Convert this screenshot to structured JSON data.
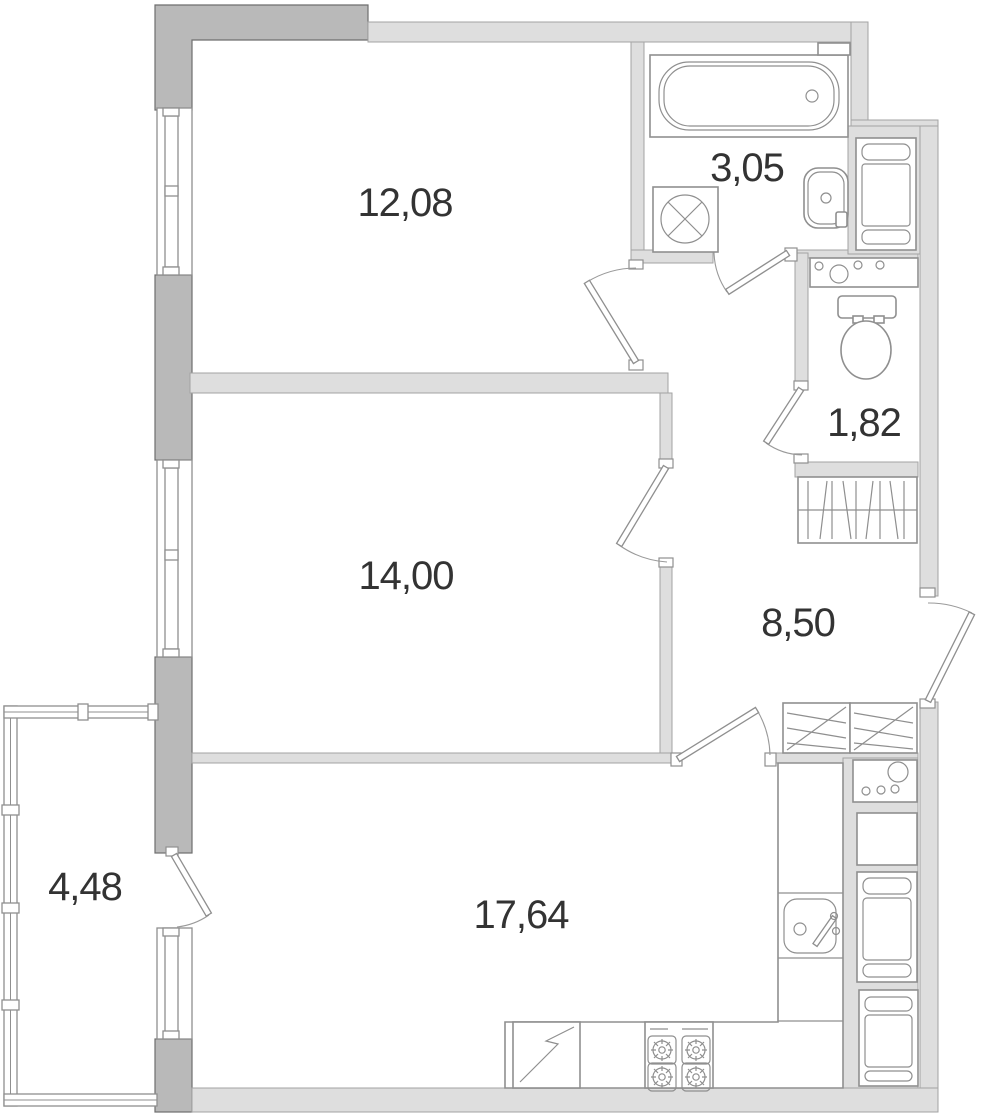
{
  "title": "apartment-floor-plan",
  "colors": {
    "background": "#ffffff",
    "wall_light": "#dedede",
    "wall_light_stroke": "#a3a3a3",
    "wall_dark": "#b9b9b9",
    "wall_dark_stroke": "#6e6e6e",
    "fixture_stroke": "#8f8f8f",
    "label_text": "#333333"
  },
  "rooms": [
    {
      "id": "bedroom-1",
      "area": "12,08"
    },
    {
      "id": "bathroom",
      "area": "3,05"
    },
    {
      "id": "wc",
      "area": "1,82"
    },
    {
      "id": "bedroom-2",
      "area": "14,00"
    },
    {
      "id": "hallway",
      "area": "8,50"
    },
    {
      "id": "living-kitchen",
      "area": "17,64"
    },
    {
      "id": "balcony",
      "area": "4,48"
    }
  ],
  "fixtures": [
    "bathtub",
    "washing-machine",
    "bathroom-sink",
    "vanity-counter",
    "toilet",
    "utility-cabinet",
    "hall-closet",
    "wardrobe-left",
    "wardrobe-right",
    "kitchen-counter",
    "kitchen-sink",
    "oven",
    "refrigerator",
    "tall-cabinet",
    "dishwasher",
    "stove"
  ],
  "doors": [
    "bedroom-1-door",
    "bathroom-door",
    "wc-door",
    "bedroom-2-door",
    "kitchen-door",
    "entry-door",
    "balcony-door"
  ],
  "windows": [
    "bedroom-1-window",
    "bedroom-2-window",
    "living-room-window",
    "balcony-glazing"
  ]
}
